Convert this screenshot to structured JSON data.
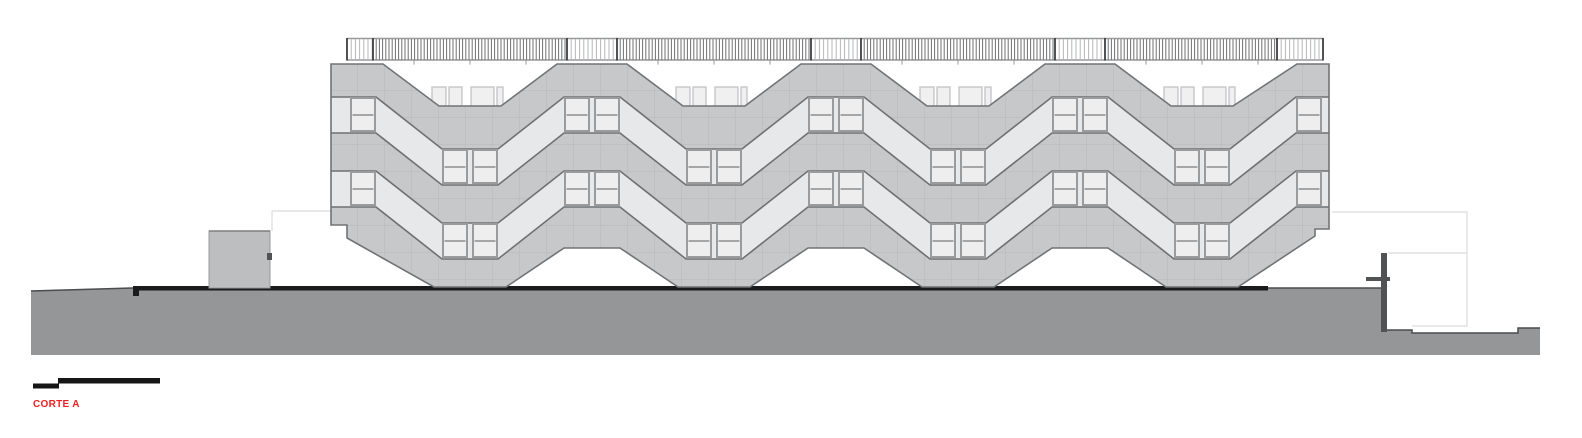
{
  "title": {
    "label": "CORTE A"
  },
  "drawing": {
    "type": "architectural-section-elevation",
    "facade_modules": 4,
    "corridor_bands": 2,
    "roof_valleys": 4,
    "ground_legs": 4,
    "has_roof_railing": true,
    "has_scale_bar": true
  },
  "colors": {
    "background": "#ffffff",
    "label": "#ed2024",
    "facade": "#c6c8ca",
    "facade_grid": "#b6b8ba",
    "outline": "#717375",
    "band": "#e7e8e9",
    "band_stroke": "#6e7072",
    "window_frame": "#9a9b9d",
    "window_pane": "#eeeeef",
    "rooftop": "#f0f0f1",
    "rooftop_stroke": "#c2c3c5",
    "rail": "#98999b",
    "picket_light": "#b6b7b9",
    "picket_dark": "#707173",
    "post": "#3e3f41",
    "ground": "#949698",
    "ground_edge": "#4b4c4e",
    "pavement": "#1b1b1d",
    "wall": "#515254",
    "faint": "#dcdcdd",
    "box": "#bdbec0",
    "box_stroke": "#98999b",
    "box_top": "#7e7f81",
    "scalebar": "#161617"
  }
}
